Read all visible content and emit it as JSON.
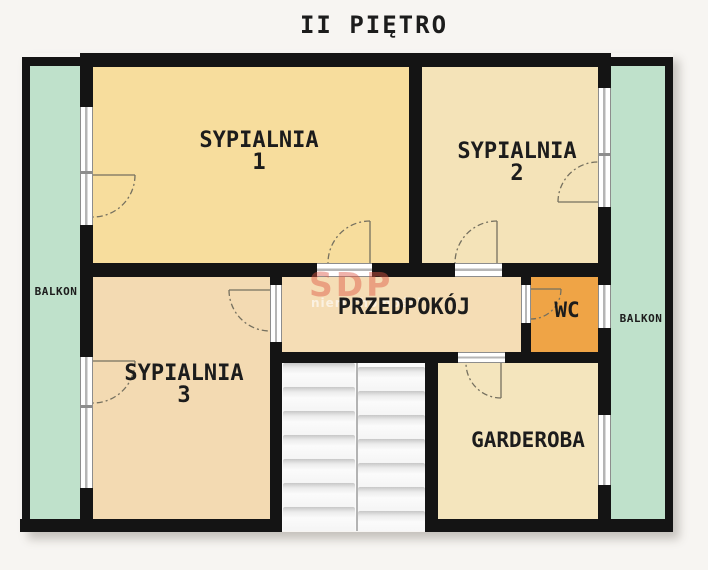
{
  "title": "II PIĘTRO",
  "floor_plan": {
    "rooms": {
      "sypialnia1": {
        "name": "SYPIALNIA",
        "number": "1"
      },
      "sypialnia2": {
        "name": "SYPIALNIA",
        "number": "2"
      },
      "sypialnia3": {
        "name": "SYPIALNIA",
        "number": "3"
      },
      "przedpokoj": {
        "name": "PRZEDPOKÓJ"
      },
      "wc": {
        "name": "WC"
      },
      "garderoba": {
        "name": "GARDEROBA"
      },
      "balkon_left": {
        "name": "BALKON"
      },
      "balkon_right": {
        "name": "BALKON"
      }
    },
    "stairs": {
      "flights": 2,
      "steps_per_flight": 7
    }
  },
  "watermark": {
    "brand": "SDP",
    "tagline": "nieruchomości"
  },
  "colors": {
    "background": "#f7f5f2",
    "wall": "#141414",
    "text": "#1c1c1c",
    "sypialnia1_floor": "#f7dd9d",
    "sypialnia2_floor": "#f4e3b8",
    "sypialnia3_floor": "#f3dab2",
    "przedpokoj_floor": "#f5ddb5",
    "wc_floor": "#efa446",
    "garderoba_floor": "#f4e5bd",
    "balkon_floor": "#bfe1cb",
    "stairs": "#fbfbfb",
    "watermark": "#dd5744",
    "door_line": "#75705f"
  }
}
